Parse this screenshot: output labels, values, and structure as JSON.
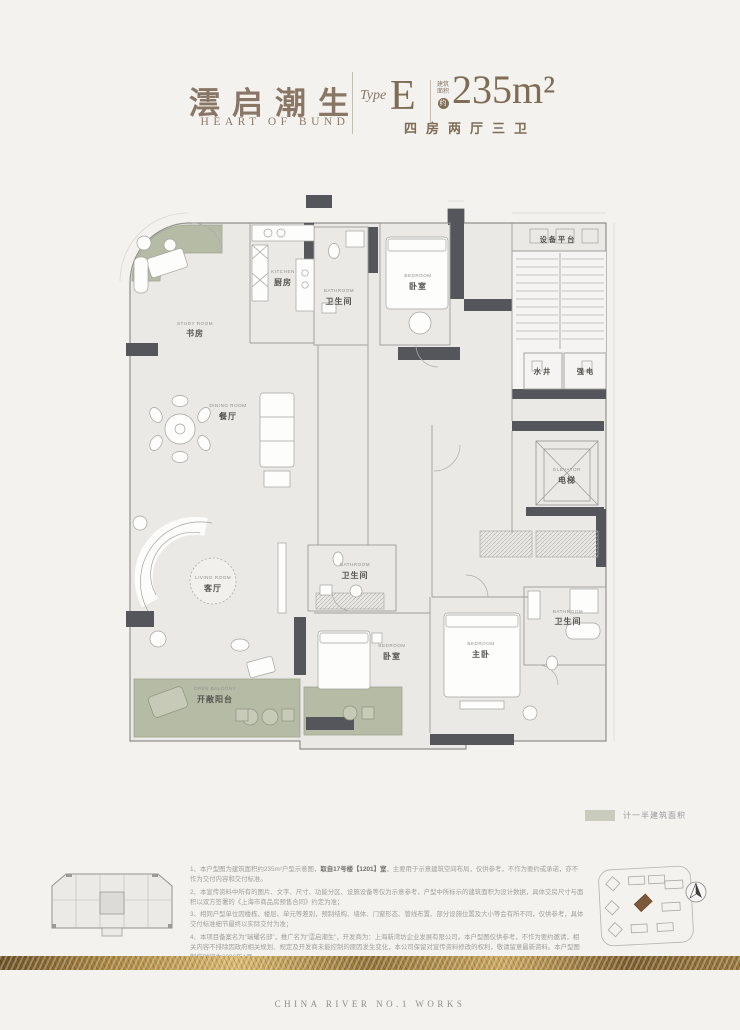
{
  "header": {
    "title_cn": "澐启潮生",
    "title_en": "HEART OF BUND",
    "type_label": "Type",
    "type_value": "E",
    "area_note_1": "建筑",
    "area_note_2": "面积",
    "area_about": "约",
    "area_value": "235m²",
    "layout": "四房两厅三卫"
  },
  "plan": {
    "rooms": [
      {
        "en": "STUDY ROOM",
        "cn": "书房"
      },
      {
        "en": "KITCHEN",
        "cn": "厨房"
      },
      {
        "en": "BATHROOM",
        "cn": "卫生间"
      },
      {
        "en": "BEDROOM",
        "cn": "卧室"
      },
      {
        "cn": "设备平台"
      },
      {
        "cn": "水井"
      },
      {
        "cn": "强电"
      },
      {
        "en": "DINING ROOM",
        "cn": "餐厅"
      },
      {
        "en": "ELEVATOR",
        "cn": "电梯"
      },
      {
        "en": "LIVING ROOM",
        "cn": "客厅"
      },
      {
        "en": "BATHROOM",
        "cn": "卫生间"
      },
      {
        "en": "BEDROOM",
        "cn": "卧室"
      },
      {
        "en": "BEDROOM",
        "cn": "主卧"
      },
      {
        "en": "BATHROOM",
        "cn": "卫生间"
      },
      {
        "en": "OPEN BALCONY",
        "cn": "开敞阳台"
      }
    ],
    "legend_label": "计一半建筑面积"
  },
  "notes": {
    "n1": {
      "num": "1、",
      "pre": "本户型图为建筑面积约235m²户型示意图，",
      "bold": "取自17号楼【1201】室",
      "post": "，主要用于示意建筑空间布局，仅供参考，不作为要约或承诺，亦不作为交付内容和交付标准。"
    },
    "n2": {
      "num": "2、",
      "text": "本宣传资料中所有的图片、文字、尺寸、功能分区、设施设备等仅为示意参考，户型中所标示的建筑面积为设计数据，具体交房尺寸与面积以双方签署的《上海市商品房预售合同》约定为准；"
    },
    "n3": {
      "num": "3、",
      "text": "相同户型单位因楼栋、楼层、单元等差别，预制结构、墙体、门窗形态、管线布置、部分设施位置及大小等会有所不同，仅供参考，具体交付标准细节最终以实际交付为准；"
    },
    "n4": {
      "num": "4、",
      "text": "本项目备案名为“瑞耀名邸”，推广名为“澐启潮生”，开发商为：上海新湾坊企业发展有限公司。本户型图仅供参考，不作为要约邀请，相关内容不排除因政府相关规划、规定及开发商未能控制的原因发生变化，本公司保留对宣传资料修改的权利，敬请留意最新资料。本户型图制作时间为2026年1月。"
    }
  },
  "footer": {
    "text": "CHINA RIVER NO.1 WORKS"
  },
  "colors": {
    "accent_brown": "#8a7664",
    "wall_dark": "#55565b",
    "sage": "#b6bba6",
    "legend_swatch": "#c9ccbd",
    "gold": "#c9a25c"
  }
}
